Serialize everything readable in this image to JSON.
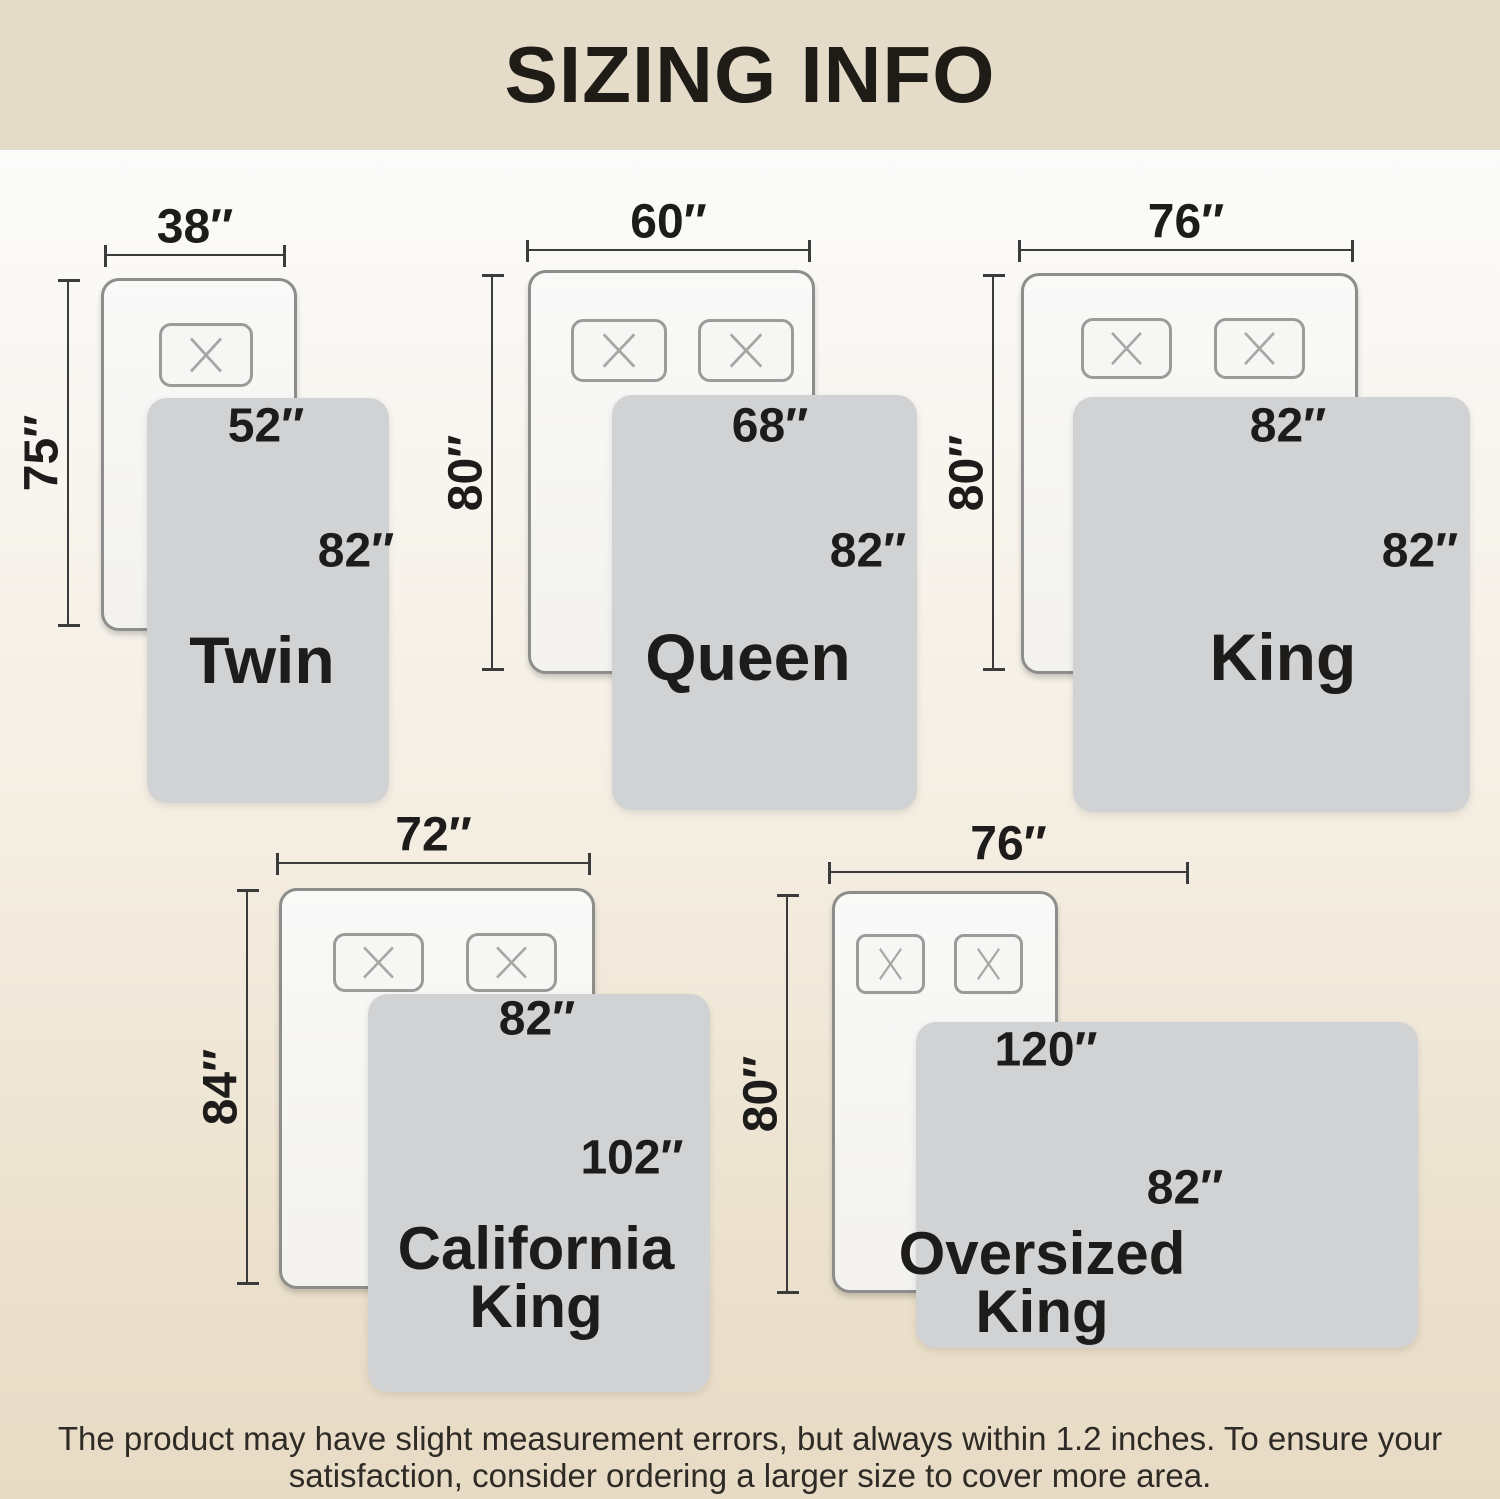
{
  "title": "SIZING INFO",
  "footer": {
    "line1": "The product may have slight measurement errors, but always within 1.2 inches. To ensure your",
    "line2": "satisfaction, consider ordering a larger size to cover more area."
  },
  "beds": [
    {
      "name_line1": "Twin",
      "name_line2": "",
      "bed_width": "38″",
      "bed_length": "75″",
      "blanket_width": "52″",
      "blanket_length": "82″"
    },
    {
      "name_line1": "Queen",
      "name_line2": "",
      "bed_width": "60″",
      "bed_length": "80″",
      "blanket_width": "68″",
      "blanket_length": "82″"
    },
    {
      "name_line1": "King",
      "name_line2": "",
      "bed_width": "76″",
      "bed_length": "80″",
      "blanket_width": "82″",
      "blanket_length": "82″"
    },
    {
      "name_line1": "California",
      "name_line2": "King",
      "bed_width": "72″",
      "bed_length": "84″",
      "blanket_width": "82″",
      "blanket_length": "102″"
    },
    {
      "name_line1": "Oversized",
      "name_line2": "King",
      "bed_width": "76″",
      "bed_length": "80″",
      "blanket_width": "120″",
      "blanket_length": "82″"
    }
  ],
  "colors": {
    "header_band": "#e4dbc8",
    "background_bottom": "#e7dbc5",
    "blanket_gray": "#d1d2d4",
    "bed_fill": "#f7f7f6",
    "bed_border": "#8d8d8b",
    "dimension_line": "#3b3b3b",
    "text": "#1d1c1a"
  }
}
